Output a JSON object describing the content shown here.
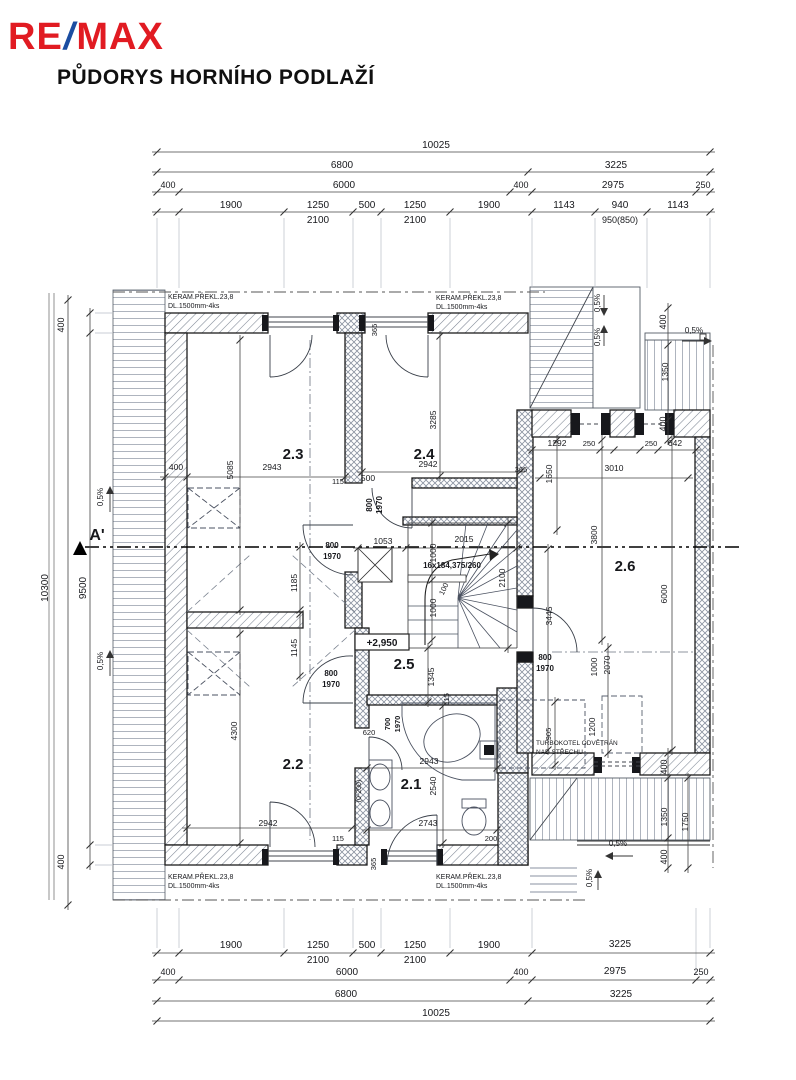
{
  "header": {
    "logo": {
      "re": "RE",
      "slash": "/",
      "max": "MAX",
      "red": "#e11b22",
      "blue": "#1b4da1"
    },
    "title": "PŮDORYS HORNÍHO PODLAŽÍ"
  },
  "plan": {
    "room_labels_note": "room numbers of upper floor",
    "labels": [
      {
        "t": "10025",
        "x": 436,
        "y": 148,
        "s": 10
      },
      {
        "t": "6800",
        "x": 342,
        "y": 168,
        "s": 10
      },
      {
        "t": "3225",
        "x": 616,
        "y": 168,
        "s": 10
      },
      {
        "t": "400",
        "x": 168,
        "y": 188,
        "s": 9
      },
      {
        "t": "6000",
        "x": 344,
        "y": 188,
        "s": 10
      },
      {
        "t": "400",
        "x": 521,
        "y": 188,
        "s": 9
      },
      {
        "t": "2975",
        "x": 613,
        "y": 188,
        "s": 10
      },
      {
        "t": "250",
        "x": 703,
        "y": 188,
        "s": 9
      },
      {
        "t": "1900",
        "x": 231,
        "y": 208,
        "s": 10
      },
      {
        "t": "1250",
        "x": 318,
        "y": 208,
        "s": 10
      },
      {
        "t": "500",
        "x": 367,
        "y": 208,
        "s": 10
      },
      {
        "t": "1250",
        "x": 415,
        "y": 208,
        "s": 10
      },
      {
        "t": "1900",
        "x": 489,
        "y": 208,
        "s": 10
      },
      {
        "t": "1143",
        "x": 564,
        "y": 208,
        "s": 10
      },
      {
        "t": "940",
        "x": 620,
        "y": 208,
        "s": 10
      },
      {
        "t": "1143",
        "x": 678,
        "y": 208,
        "s": 10
      },
      {
        "t": "2100",
        "x": 318,
        "y": 223,
        "s": 10
      },
      {
        "t": "2100",
        "x": 415,
        "y": 223,
        "s": 10
      },
      {
        "t": "950(850)",
        "x": 620,
        "y": 223,
        "s": 9
      },
      {
        "t": "1900",
        "x": 231,
        "y": 948,
        "s": 10
      },
      {
        "t": "1250",
        "x": 318,
        "y": 948,
        "s": 10
      },
      {
        "t": "500",
        "x": 367,
        "y": 948,
        "s": 10
      },
      {
        "t": "1250",
        "x": 415,
        "y": 948,
        "s": 10
      },
      {
        "t": "1900",
        "x": 489,
        "y": 948,
        "s": 10
      },
      {
        "t": "3225",
        "x": 620,
        "y": 947,
        "s": 10
      },
      {
        "t": "2100",
        "x": 318,
        "y": 963,
        "s": 10
      },
      {
        "t": "2100",
        "x": 415,
        "y": 963,
        "s": 10
      },
      {
        "t": "400",
        "x": 168,
        "y": 975,
        "s": 9
      },
      {
        "t": "6000",
        "x": 347,
        "y": 975,
        "s": 10
      },
      {
        "t": "400",
        "x": 521,
        "y": 975,
        "s": 9
      },
      {
        "t": "2975",
        "x": 615,
        "y": 974,
        "s": 10
      },
      {
        "t": "250",
        "x": 701,
        "y": 975,
        "s": 9
      },
      {
        "t": "6800",
        "x": 346,
        "y": 997,
        "s": 10
      },
      {
        "t": "3225",
        "x": 621,
        "y": 997,
        "s": 10
      },
      {
        "t": "10025",
        "x": 436,
        "y": 1016,
        "s": 10
      },
      {
        "t": "10300",
        "x": 48,
        "y": 588,
        "s": 10,
        "r": -90
      },
      {
        "t": "9500",
        "x": 86,
        "y": 588,
        "s": 10,
        "r": -90
      },
      {
        "t": "400",
        "x": 64,
        "y": 325,
        "s": 9,
        "r": -90
      },
      {
        "t": "400",
        "x": 64,
        "y": 862,
        "s": 9,
        "r": -90
      },
      {
        "t": "KERAM.PŘEKL.23,8",
        "x": 168,
        "y": 299,
        "s": 7,
        "a": "start"
      },
      {
        "t": "DL.1500mm-4ks",
        "x": 168,
        "y": 308,
        "s": 7,
        "a": "start"
      },
      {
        "t": "KERAM.PŘEKL.23,8",
        "x": 436,
        "y": 300,
        "s": 7,
        "a": "start"
      },
      {
        "t": "DL.1500mm-4ks",
        "x": 436,
        "y": 309,
        "s": 7,
        "a": "start"
      },
      {
        "t": "KERAM.PŘEKL.23,8",
        "x": 168,
        "y": 879,
        "s": 7,
        "a": "start"
      },
      {
        "t": "DL.1500mm-4ks",
        "x": 168,
        "y": 888,
        "s": 7,
        "a": "start"
      },
      {
        "t": "KERAM.PŘEKL.23,8",
        "x": 436,
        "y": 879,
        "s": 7,
        "a": "start"
      },
      {
        "t": "DL.1500mm-4ks",
        "x": 436,
        "y": 888,
        "s": 7,
        "a": "start"
      },
      {
        "t": "TURBOKOTEL ODVĚTRÁN",
        "x": 536,
        "y": 745,
        "s": 6.5,
        "a": "start"
      },
      {
        "t": "NAD STŘECHU",
        "x": 536,
        "y": 754,
        "s": 6.5,
        "a": "start"
      },
      {
        "t": "2.3",
        "x": 293,
        "y": 459,
        "s": 15,
        "b": 1
      },
      {
        "t": "2.4",
        "x": 424,
        "y": 459,
        "s": 15,
        "b": 1
      },
      {
        "t": "2.5",
        "x": 404,
        "y": 669,
        "s": 15,
        "b": 1
      },
      {
        "t": "2.2",
        "x": 293,
        "y": 769,
        "s": 15,
        "b": 1
      },
      {
        "t": "2.1",
        "x": 411,
        "y": 789,
        "s": 15,
        "b": 1
      },
      {
        "t": "2.6",
        "x": 625,
        "y": 571,
        "s": 15,
        "b": 1
      },
      {
        "t": "+2,950",
        "x": 382,
        "y": 646,
        "s": 10,
        "b": 1
      },
      {
        "t": "16x184,375/260",
        "x": 452,
        "y": 568,
        "s": 8,
        "b": 1
      },
      {
        "t": "0,5%",
        "x": 103,
        "y": 497,
        "s": 8,
        "r": -90
      },
      {
        "t": "0,5%",
        "x": 103,
        "y": 661,
        "s": 8,
        "r": -90
      },
      {
        "t": "0,5%",
        "x": 600,
        "y": 303,
        "s": 8,
        "r": -90
      },
      {
        "t": "0,5%",
        "x": 600,
        "y": 337,
        "s": 8,
        "r": -90
      },
      {
        "t": "0,5%",
        "x": 694,
        "y": 333,
        "s": 8
      },
      {
        "t": "0,5%",
        "x": 618,
        "y": 846,
        "s": 8
      },
      {
        "t": "0,5%",
        "x": 592,
        "y": 878,
        "s": 8,
        "r": -90
      },
      {
        "t": "A'",
        "x": 97,
        "y": 540,
        "s": 16,
        "b": 1
      },
      {
        "t": "400",
        "x": 176,
        "y": 470,
        "s": 8.5
      },
      {
        "t": "5085",
        "x": 233,
        "y": 470,
        "s": 8.5,
        "r": -90
      },
      {
        "t": "2943",
        "x": 272,
        "y": 470,
        "s": 8.5
      },
      {
        "t": "115",
        "x": 338,
        "y": 484,
        "s": 7.5
      },
      {
        "t": "500",
        "x": 368,
        "y": 481,
        "s": 8.5
      },
      {
        "t": "800",
        "x": 372,
        "y": 505,
        "s": 8,
        "r": -90,
        "b": 1
      },
      {
        "t": "1970",
        "x": 382,
        "y": 505,
        "s": 8,
        "r": -90,
        "b": 1
      },
      {
        "t": "365",
        "x": 377,
        "y": 330,
        "s": 7.5,
        "r": -90
      },
      {
        "t": "3285",
        "x": 436,
        "y": 420,
        "s": 8.5,
        "r": -90
      },
      {
        "t": "2942",
        "x": 428,
        "y": 467,
        "s": 8.5
      },
      {
        "t": "365",
        "x": 521,
        "y": 472,
        "s": 7.5
      },
      {
        "t": "800",
        "x": 332,
        "y": 548,
        "s": 8,
        "b": 1
      },
      {
        "t": "1970",
        "x": 332,
        "y": 559,
        "s": 8,
        "b": 1
      },
      {
        "t": "1053",
        "x": 383,
        "y": 544,
        "s": 8.5
      },
      {
        "t": "1000",
        "x": 436,
        "y": 553,
        "s": 8.5,
        "r": -90
      },
      {
        "t": "2015",
        "x": 464,
        "y": 542,
        "s": 8.5
      },
      {
        "t": "100",
        "x": 446,
        "y": 590,
        "s": 7.5,
        "r": -65
      },
      {
        "t": "2100",
        "x": 505,
        "y": 578,
        "s": 8.5,
        "r": -90
      },
      {
        "t": "1000",
        "x": 436,
        "y": 608,
        "s": 8.5,
        "r": -90
      },
      {
        "t": "1185",
        "x": 297,
        "y": 583,
        "s": 8.5,
        "r": -90
      },
      {
        "t": "1345",
        "x": 434,
        "y": 677,
        "s": 8.5,
        "r": -90
      },
      {
        "t": "3445",
        "x": 552,
        "y": 616,
        "s": 8.5,
        "r": -90
      },
      {
        "t": "800",
        "x": 545,
        "y": 660,
        "s": 8,
        "b": 1
      },
      {
        "t": "1970",
        "x": 545,
        "y": 671,
        "s": 8,
        "b": 1
      },
      {
        "t": "1650",
        "x": 552,
        "y": 474,
        "s": 8.5,
        "r": -90
      },
      {
        "t": "1292",
        "x": 557,
        "y": 446,
        "s": 8.5
      },
      {
        "t": "250",
        "x": 589,
        "y": 446,
        "s": 7.5
      },
      {
        "t": "250",
        "x": 651,
        "y": 446,
        "s": 7.5
      },
      {
        "t": "642",
        "x": 675,
        "y": 446,
        "s": 8.5
      },
      {
        "t": "3010",
        "x": 614,
        "y": 471,
        "s": 8.5
      },
      {
        "t": "3800",
        "x": 597,
        "y": 535,
        "s": 8.5,
        "r": -90
      },
      {
        "t": "6000",
        "x": 667,
        "y": 594,
        "s": 8.5,
        "r": -90
      },
      {
        "t": "1000",
        "x": 597,
        "y": 667,
        "s": 8.5,
        "r": -90
      },
      {
        "t": "2070",
        "x": 610,
        "y": 665,
        "s": 8.5,
        "r": -90
      },
      {
        "t": "1200",
        "x": 595,
        "y": 727,
        "s": 8.5,
        "r": -90
      },
      {
        "t": "905",
        "x": 551,
        "y": 734,
        "s": 7.5,
        "r": -90
      },
      {
        "t": "115",
        "x": 449,
        "y": 699,
        "s": 7.5,
        "r": -90
      },
      {
        "t": "2943",
        "x": 429,
        "y": 764,
        "s": 8.5
      },
      {
        "t": "2540",
        "x": 436,
        "y": 786,
        "s": 8.5,
        "r": -90
      },
      {
        "t": "2743",
        "x": 428,
        "y": 826,
        "s": 8.5
      },
      {
        "t": "200",
        "x": 491,
        "y": 841,
        "s": 7.5
      },
      {
        "t": "620",
        "x": 369,
        "y": 735,
        "s": 7.5
      },
      {
        "t": "700",
        "x": 390,
        "y": 724,
        "s": 7.5,
        "r": -90,
        "b": 1
      },
      {
        "t": "1970",
        "x": 400,
        "y": 724,
        "s": 7.5,
        "r": -90,
        "b": 1
      },
      {
        "t": "(0-200)",
        "x": 361,
        "y": 791,
        "s": 7,
        "r": -90
      },
      {
        "t": "800",
        "x": 331,
        "y": 676,
        "s": 8,
        "b": 1
      },
      {
        "t": "1970",
        "x": 331,
        "y": 687,
        "s": 8,
        "b": 1
      },
      {
        "t": "1145",
        "x": 297,
        "y": 648,
        "s": 8.5,
        "r": -90
      },
      {
        "t": "4300",
        "x": 237,
        "y": 731,
        "s": 8.5,
        "r": -90
      },
      {
        "t": "2942",
        "x": 268,
        "y": 826,
        "s": 8.5
      },
      {
        "t": "115",
        "x": 338,
        "y": 841,
        "s": 7.5
      },
      {
        "t": "365",
        "x": 376,
        "y": 864,
        "s": 7.5,
        "r": -90
      },
      {
        "t": "1350",
        "x": 668,
        "y": 372,
        "s": 8.5,
        "r": -90
      },
      {
        "t": "400",
        "x": 666,
        "y": 322,
        "s": 9,
        "r": -90
      },
      {
        "t": "400",
        "x": 666,
        "y": 424,
        "s": 9,
        "r": -90
      },
      {
        "t": "1350",
        "x": 667,
        "y": 817,
        "s": 8.5,
        "r": -90
      },
      {
        "t": "1750",
        "x": 688,
        "y": 822,
        "s": 8.5,
        "r": -90
      },
      {
        "t": "400",
        "x": 667,
        "y": 767,
        "s": 9,
        "r": -90
      },
      {
        "t": "400",
        "x": 667,
        "y": 857,
        "s": 9,
        "r": -90
      }
    ],
    "dim_rows": [
      {
        "o": "h",
        "pos": 152,
        "ticks": [
          157,
          710
        ]
      },
      {
        "o": "h",
        "pos": 172,
        "ticks": [
          157,
          528,
          710
        ]
      },
      {
        "o": "h",
        "pos": 192,
        "ticks": [
          157,
          179,
          510,
          532,
          696,
          710
        ]
      },
      {
        "o": "h",
        "pos": 212,
        "ticks": [
          157,
          179,
          284,
          353,
          381,
          450,
          532,
          595,
          647,
          710
        ]
      },
      {
        "o": "h",
        "pos": 953,
        "ticks": [
          157,
          179,
          284,
          353,
          381,
          450,
          532,
          710
        ]
      },
      {
        "o": "h",
        "pos": 980,
        "ticks": [
          157,
          179,
          510,
          532,
          696,
          710
        ]
      },
      {
        "o": "h",
        "pos": 1001,
        "ticks": [
          157,
          528,
          710
        ]
      },
      {
        "o": "h",
        "pos": 1021,
        "ticks": [
          157,
          710
        ]
      },
      {
        "o": "v",
        "pos": 68,
        "ticks": [
          300,
          905
        ]
      },
      {
        "o": "v",
        "pos": 90,
        "ticks": [
          313,
          333,
          845,
          865
        ]
      },
      {
        "o": "v",
        "pos": 668,
        "ticks": [
          308,
          345,
          420,
          440
        ]
      },
      {
        "o": "v",
        "pos": 668,
        "ticks": [
          753,
          778,
          838,
          868
        ]
      },
      {
        "o": "v",
        "pos": 688,
        "ticks": [
          778,
          868
        ]
      },
      {
        "o": "v",
        "pos": 240,
        "ticks": [
          340,
          610
        ]
      },
      {
        "o": "v",
        "pos": 240,
        "ticks": [
          634,
          843
        ]
      },
      {
        "o": "h",
        "pos": 477,
        "ticks": [
          165,
          187,
          345
        ]
      },
      {
        "o": "h",
        "pos": 472,
        "ticks": [
          362,
          520
        ]
      },
      {
        "o": "v",
        "pos": 440,
        "ticks": [
          336,
          476
        ]
      },
      {
        "o": "h",
        "pos": 828,
        "ticks": [
          187,
          352
        ]
      },
      {
        "o": "v",
        "pos": 300,
        "ticks": [
          547,
          610
        ]
      },
      {
        "o": "v",
        "pos": 300,
        "ticks": [
          614,
          676
        ]
      },
      {
        "o": "h",
        "pos": 450,
        "ticks": [
          532,
          600,
          614,
          640,
          658,
          696
        ]
      },
      {
        "o": "h",
        "pos": 478,
        "ticks": [
          540,
          688
        ]
      },
      {
        "o": "v",
        "pos": 557,
        "ticks": [
          440,
          530
        ]
      },
      {
        "o": "v",
        "pos": 602,
        "ticks": [
          440,
          640
        ]
      },
      {
        "o": "v",
        "pos": 672,
        "ticks": [
          440,
          750
        ]
      },
      {
        "o": "v",
        "pos": 548,
        "ticks": [
          549,
          750
        ]
      },
      {
        "o": "v",
        "pos": 608,
        "ticks": [
          648,
          753
        ]
      },
      {
        "o": "h",
        "pos": 768,
        "ticks": [
          367,
          497
        ]
      },
      {
        "o": "h",
        "pos": 830,
        "ticks": [
          367,
          497
        ]
      },
      {
        "o": "v",
        "pos": 443,
        "ticks": [
          706,
          843
        ]
      },
      {
        "o": "h",
        "pos": 548,
        "ticks": [
          358,
          406,
          517
        ]
      },
      {
        "o": "v",
        "pos": 432,
        "ticks": [
          523,
          580,
          640
        ]
      },
      {
        "o": "v",
        "pos": 508,
        "ticks": [
          523,
          648
        ]
      },
      {
        "o": "v",
        "pos": 428,
        "ticks": [
          648,
          702
        ]
      },
      {
        "o": "v",
        "pos": 555,
        "ticks": [
          702,
          765
        ]
      }
    ]
  },
  "colors": {
    "wall_line": "#1c1c1c",
    "hatch": "#7d8694",
    "dim_line": "#444444",
    "accent_red": "#e11b22",
    "accent_blue": "#1b4da1"
  }
}
